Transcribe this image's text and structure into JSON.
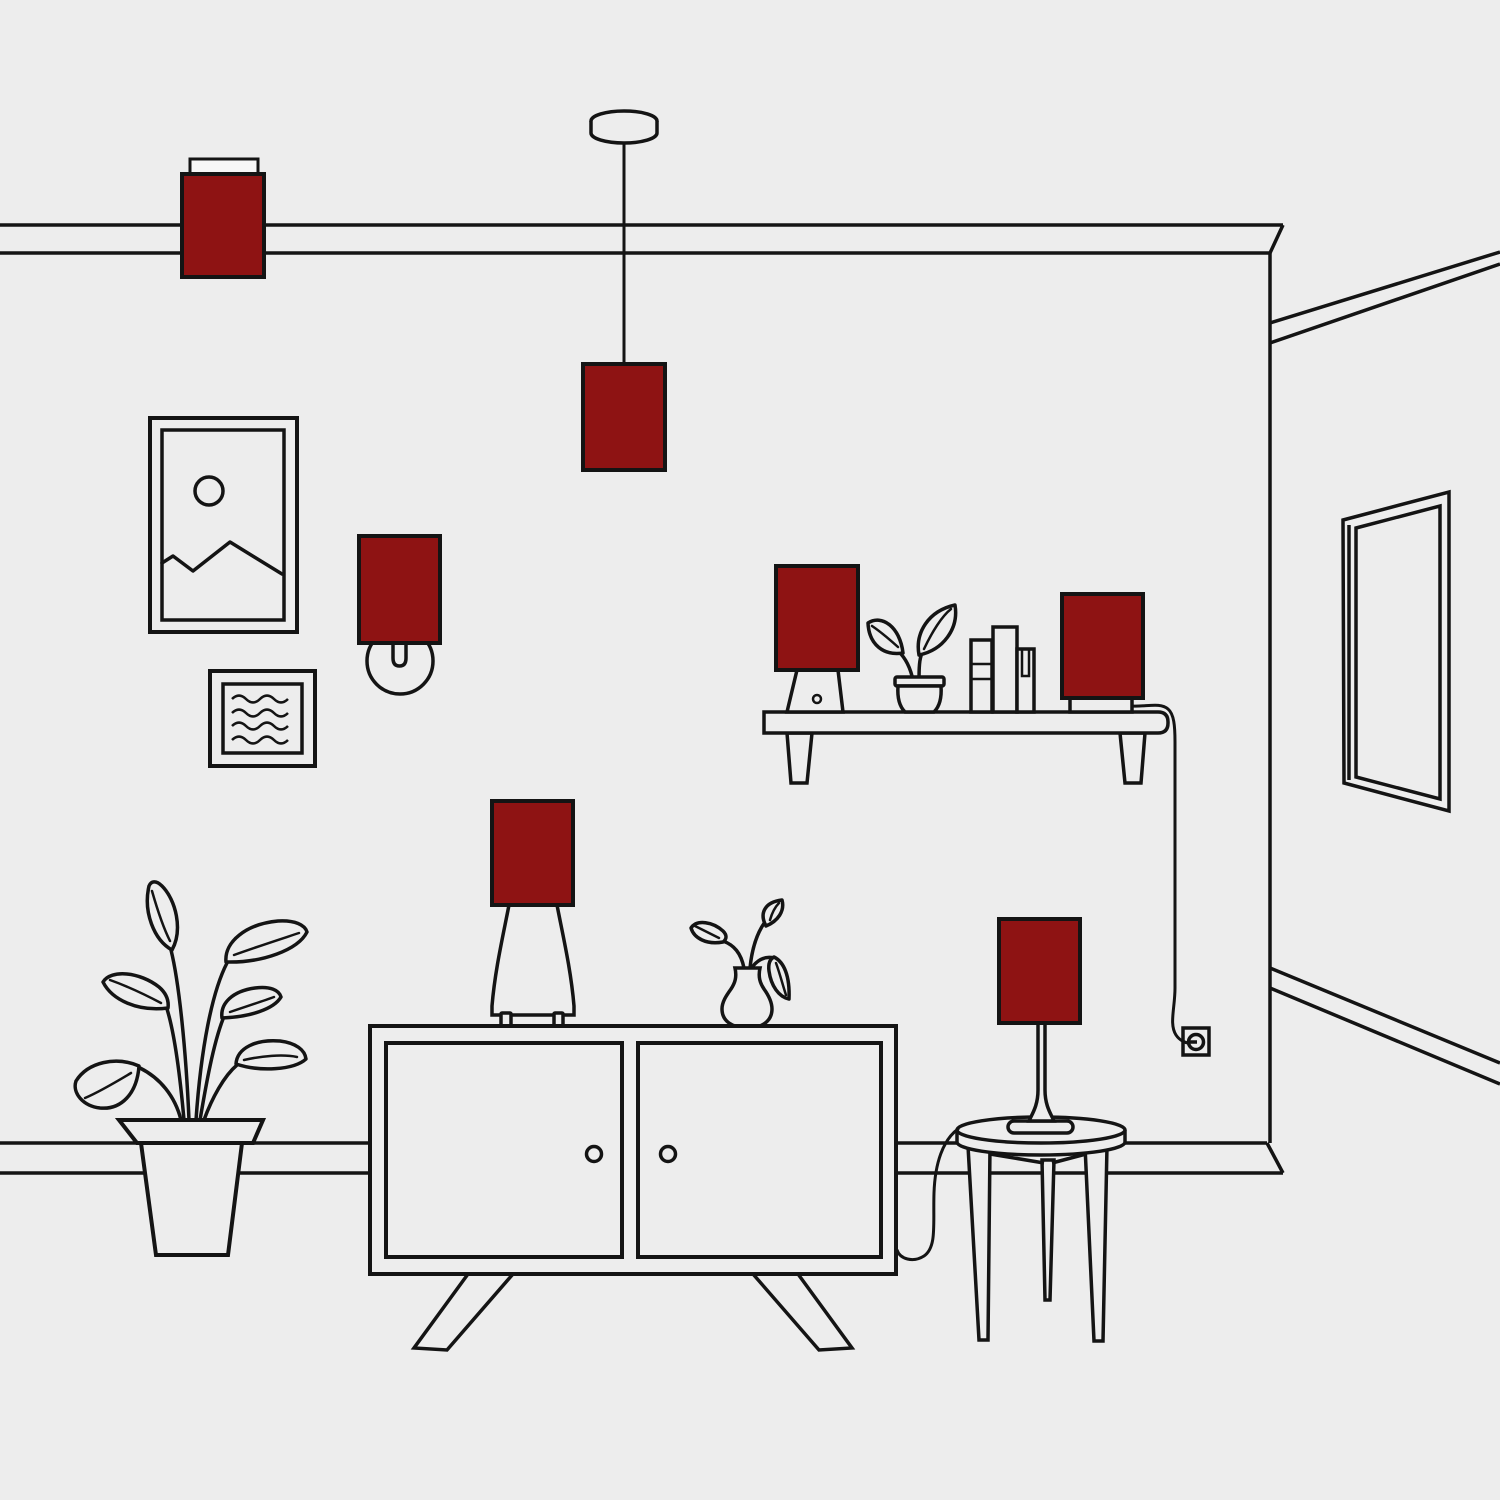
{
  "scene": {
    "description": "Minimal line-art illustration of a living-room interior; every lamp is fitted with a dark red rectangular shade",
    "lamp_count": 7,
    "objects": [
      "flush ceiling lamp",
      "pendant lamp on cord",
      "framed mountain picture",
      "framed wave picture",
      "wall sconce lamp",
      "wall shelf with table lamp, potted plant, three books and accent lamp",
      "power cord running to wall outlet",
      "wall mirror in perspective",
      "floor plant in tapered pot",
      "two-door sideboard on splayed legs",
      "table lamp on sideboard",
      "vase with sprigs",
      "round three-leg side table",
      "slim table lamp on side table with cord"
    ]
  },
  "colors": {
    "bg": "#ededed",
    "line": "#141414",
    "lampshade": "#8e1313",
    "mount": "#f7f7f7"
  }
}
